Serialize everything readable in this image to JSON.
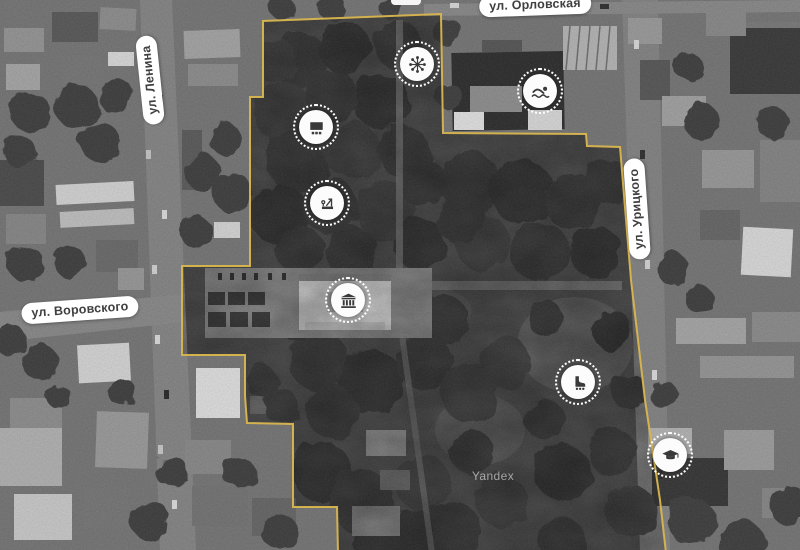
{
  "map": {
    "provider_watermark": "Yandex",
    "boundary": {
      "color": "#d9b64f",
      "points": [
        [
          338,
          553
        ],
        [
          337,
          507
        ],
        [
          293,
          507
        ],
        [
          293,
          424
        ],
        [
          247,
          423
        ],
        [
          245,
          396
        ],
        [
          245,
          355
        ],
        [
          182,
          355
        ],
        [
          182,
          266
        ],
        [
          250,
          266
        ],
        [
          250,
          97
        ],
        [
          263,
          97
        ],
        [
          263,
          21
        ],
        [
          441,
          14
        ],
        [
          443,
          133
        ],
        [
          586,
          134
        ],
        [
          587,
          146
        ],
        [
          620,
          147
        ],
        [
          631,
          280
        ],
        [
          645,
          400
        ],
        [
          660,
          500
        ],
        [
          666,
          553
        ]
      ]
    },
    "street_labels": [
      {
        "name": "orlovskaya",
        "text": "ул. Орловская",
        "x": 535,
        "y": 5,
        "rotation": -2
      },
      {
        "name": "lenina",
        "text": "ул. Ленина",
        "x": 150,
        "y": 80,
        "rotation": -96
      },
      {
        "name": "vorovskogo",
        "text": "ул. Воровского",
        "x": 80,
        "y": 310,
        "rotation": -4
      },
      {
        "name": "uritskogo",
        "text": "ул. Урицкого",
        "x": 637,
        "y": 209,
        "rotation": -94
      }
    ],
    "markers": [
      {
        "name": "attractions",
        "icon": "ferris-wheel-icon",
        "x": 417,
        "y": 64
      },
      {
        "name": "swimming-pool",
        "icon": "swimmer-icon",
        "x": 540,
        "y": 91
      },
      {
        "name": "summer-cinema",
        "icon": "cinema-screen-icon",
        "x": 316,
        "y": 127
      },
      {
        "name": "playground",
        "icon": "playground-icon",
        "x": 327,
        "y": 203
      },
      {
        "name": "philharmonic",
        "icon": "classical-building-icon",
        "x": 348,
        "y": 300
      },
      {
        "name": "rollerdrome",
        "icon": "roller-skate-icon",
        "x": 578,
        "y": 382
      },
      {
        "name": "education",
        "icon": "graduation-cap-icon",
        "x": 670,
        "y": 455
      }
    ]
  }
}
